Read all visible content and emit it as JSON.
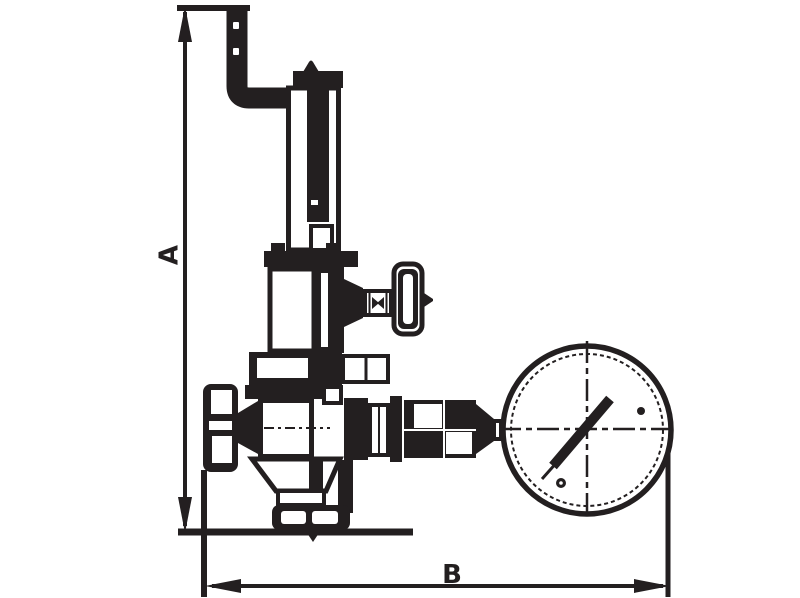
{
  "drawing": {
    "dimension_a_label": "A",
    "dimension_b_label": "B"
  },
  "colors": {
    "ink": "#231f20",
    "background": "#ffffff"
  }
}
